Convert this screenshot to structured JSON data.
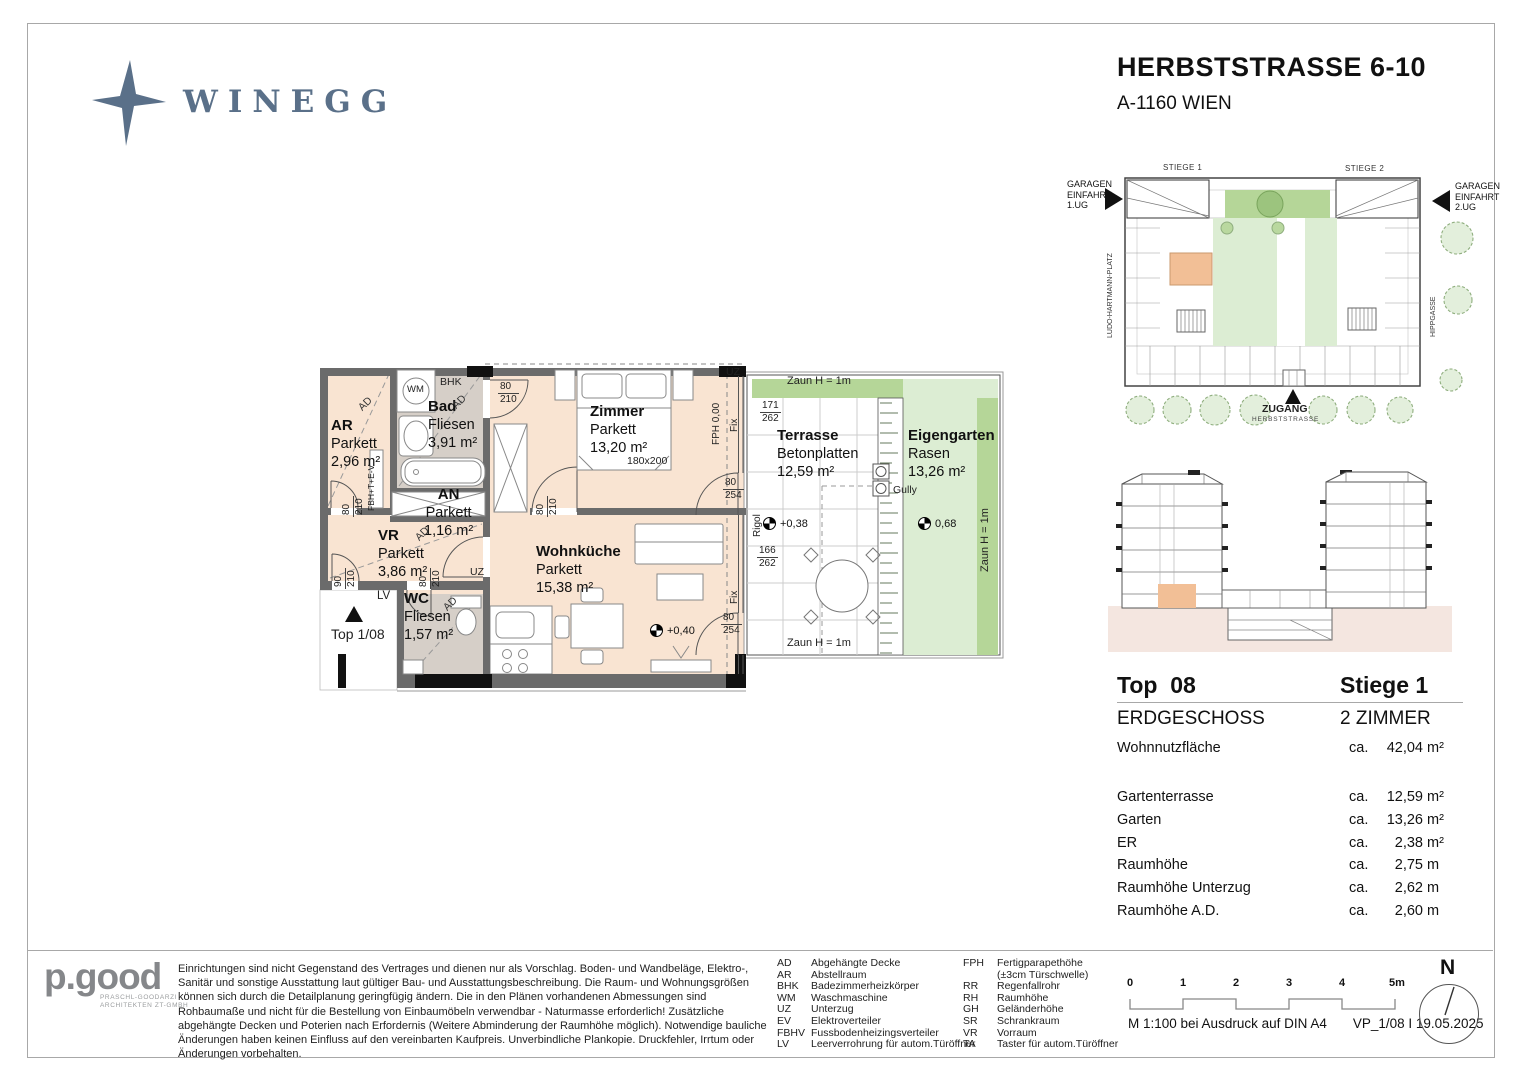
{
  "header": {
    "brand": "WINEGG",
    "title": "HERBSTSTRASSE 6-10",
    "subtitle": "A-1160 WIEN"
  },
  "colors": {
    "brand": "#5a7089",
    "parkett": "#f9e4d2",
    "fliesen": "#d6cfc8",
    "rasen": "#dcedd3",
    "zaun_band": "#b5d698",
    "unit_highlight": "#f2bf96",
    "wall": "#6b6b6b"
  },
  "plan": {
    "rooms": {
      "ar": {
        "name": "AR",
        "floor": "Parkett",
        "area": "2,96 m²"
      },
      "bad": {
        "name": "Bad",
        "floor": "Fliesen",
        "area": "3,91 m²"
      },
      "an": {
        "name": "AN",
        "floor": "Parkett",
        "area": "1,16 m²"
      },
      "vr": {
        "name": "VR",
        "floor": "Parkett",
        "area": "3,86 m²"
      },
      "wc": {
        "name": "WC",
        "floor": "Fliesen",
        "area": "1,57 m²"
      },
      "zimmer": {
        "name": "Zimmer",
        "floor": "Parkett",
        "area": "13,20 m²"
      },
      "wohnkueche": {
        "name": "Wohnküche",
        "floor": "Parkett",
        "area": "15,38 m²"
      },
      "terrasse": {
        "name": "Terrasse",
        "floor": "Betonplatten",
        "area": "12,59 m²"
      },
      "eigengarten": {
        "name": "Eigengarten",
        "floor": "Rasen",
        "area": "13,26 m²"
      }
    },
    "dims": {
      "bad_door": {
        "w": "80",
        "h": "210"
      },
      "zimmer_door": {
        "w": "80",
        "h": "210"
      },
      "ar_door": {
        "w": "80",
        "h": "210"
      },
      "entry_door": {
        "w": "90",
        "h": "210"
      },
      "vr_door": {
        "w": "80",
        "h": "210"
      },
      "window_upper": {
        "w": "80",
        "h": "254"
      },
      "window_lower": {
        "w": "80",
        "h": "254"
      },
      "terrace_upper": {
        "w": "171",
        "h": "262"
      },
      "terrace_lower": {
        "w": "166",
        "h": "262"
      }
    },
    "ann": {
      "wm": "WM",
      "bhk": "BHK",
      "ad": "AD",
      "uz": "UZ",
      "lv": "LV",
      "fbh": "FBH+T+E-V",
      "fph": "FPH 0,00",
      "fix": "Fix",
      "rigol": "Rigol",
      "gully": "Gully",
      "bed": "180x200",
      "zaun": "Zaun H = 1m",
      "top_marker": "Top 1/08",
      "lvl_wohn": "+0,40",
      "lvl_terr": "+0,38",
      "lvl_garten": "0,68"
    }
  },
  "site": {
    "stiege1": "STIEGE 1",
    "stiege2": "STIEGE 2",
    "garage1": "GARAGEN EINFAHRT 1.UG",
    "garage2": "GARAGEN EINFAHRT 2.UG",
    "ludo": "LUDO-HARTMANN-PLATZ",
    "hipp": "HIPPGASSE",
    "zugang": "ZUGANG",
    "street": "HERBSTSTRASSE"
  },
  "info": {
    "top": "Top  08",
    "stiege": "Stiege 1",
    "floor": "ERDGESCHOSS",
    "rooms": "2 ZIMMER",
    "ca": "ca.",
    "rows": [
      {
        "label": "Wohnnutzfläche",
        "number": "42,04",
        "unit": "m²"
      },
      {
        "label": "Gartenterrasse",
        "number": "12,59",
        "unit": "m²"
      },
      {
        "label": "Garten",
        "number": "13,26",
        "unit": "m²"
      },
      {
        "label": "ER",
        "number": "2,38",
        "unit": "m²"
      },
      {
        "label": "Raumhöhe",
        "number": "2,75",
        "unit": "m"
      },
      {
        "label": "Raumhöhe Unterzug",
        "number": "2,62",
        "unit": "m"
      },
      {
        "label": "Raumhöhe A.D.",
        "number": "2,60",
        "unit": "m"
      }
    ]
  },
  "footer": {
    "architect": {
      "name": "p.good",
      "line1": "PRASCHL-GOODARZI",
      "line2": "ARCHITEKTEN ZT-GMBH"
    },
    "disclaimer": "Einrichtungen sind nicht Gegenstand des Vertrages und dienen nur als Vorschlag. Boden- und Wandbeläge, Elektro-, Sanitär und sonstige Ausstattung laut gültiger Bau- und Ausstattungsbeschreibung. Die Raum- und Wohnungsgrößen können sich durch die Detailplanung geringfügig ändern. Die in den Plänen vorhandenen Abmessungen sind Rohbaumaße und nicht für die Bestellung von Einbaumöbeln verwendbar - Naturmasse erforderlich! Zusätzliche abgehängte Decken und Poterien nach Erfordernis (Weitere Abminderung der Raumhöhe möglich). Notwendige bauliche Änderungen haben keinen Einfluss auf den vereinbarten Kaufpreis. Unverbindliche Plankopie. Druckfehler, Irrtum oder Änderungen vorbehalten.",
    "legend1": [
      {
        "abbr": "AD",
        "label": "Abgehängte Decke"
      },
      {
        "abbr": "AR",
        "label": "Abstellraum"
      },
      {
        "abbr": "BHK",
        "label": "Badezimmerheizkörper"
      },
      {
        "abbr": "WM",
        "label": "Waschmaschine"
      },
      {
        "abbr": "UZ",
        "label": "Unterzug"
      },
      {
        "abbr": "EV",
        "label": "Elektroverteiler"
      },
      {
        "abbr": "FBHV",
        "label": "Fussbodenheizingsverteiler"
      },
      {
        "abbr": "LV",
        "label": "Leerverrohrung für autom.Türöffner"
      }
    ],
    "legend2": [
      {
        "abbr": "FPH",
        "label": "Fertigparapethöhe"
      },
      {
        "abbr": "",
        "label": "(±3cm Türschwelle)"
      },
      {
        "abbr": "RR",
        "label": "Regenfallrohr"
      },
      {
        "abbr": "RH",
        "label": "Raumhöhe"
      },
      {
        "abbr": "GH",
        "label": "Geländerhöhe"
      },
      {
        "abbr": "SR",
        "label": "Schrankraum"
      },
      {
        "abbr": "VR",
        "label": "Vorraum"
      },
      {
        "abbr": "TA",
        "label": "Taster für autom.Türöffner"
      }
    ],
    "scale": {
      "t0": "0",
      "t1": "1",
      "t2": "2",
      "t3": "3",
      "t4": "4",
      "t5": "5m",
      "note": "M 1:100 bei Ausdruck auf DIN A4",
      "version": "VP_1/08 I 19.05.2025"
    },
    "north": "N"
  }
}
